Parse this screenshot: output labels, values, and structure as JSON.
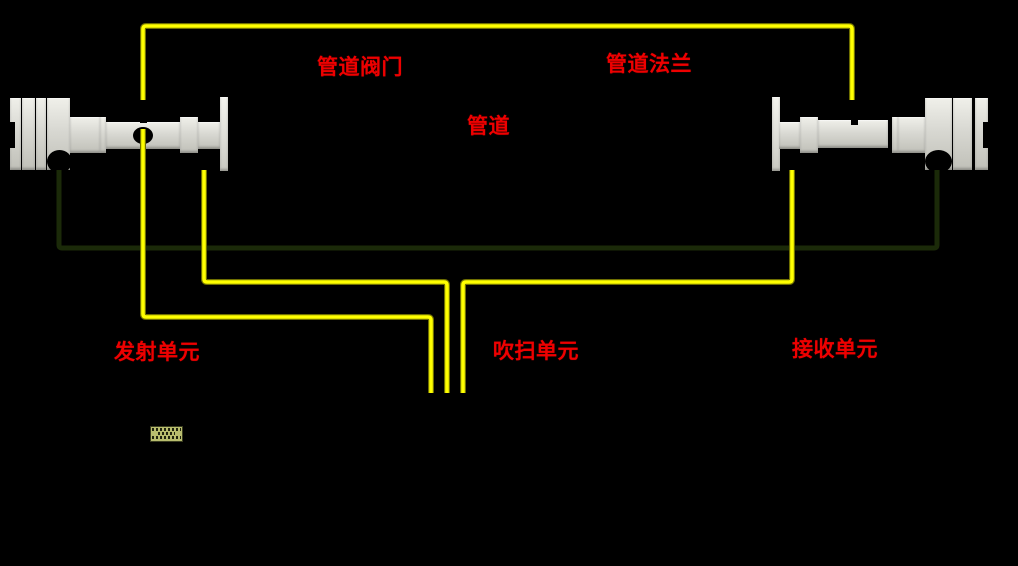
{
  "colors": {
    "bg": "#000000",
    "line_yellow": "#ffff00",
    "line_yellow_edge": "#6e6e00",
    "line_green": "#1b2a09",
    "label_red": "#ee0000",
    "device_fill": "#d8d8d2",
    "lcd_bg": "#b8bd6e"
  },
  "labels": {
    "pipe_valve": "管道阀门",
    "pipe_flange": "管道法兰",
    "pipe": "管道",
    "transmit_unit": "发射单元",
    "purge_unit": "吹扫单元",
    "receive_unit": "接收单元"
  }
}
